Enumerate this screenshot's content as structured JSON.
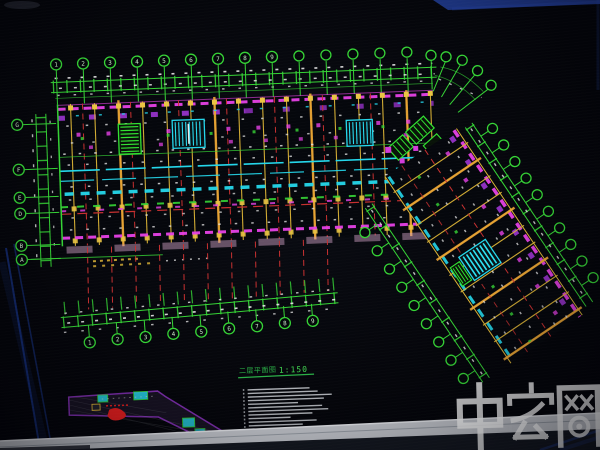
{
  "colors": {
    "background": "#05060b",
    "dimension_green": "#3bd23b",
    "grid_yellow": "#d9b33c",
    "column_orange": "#e8a43a",
    "wall_magenta": "#e043e0",
    "hatch_purple": "#a238d8",
    "detail_cyan": "#2bd5e8",
    "axis_red": "#c23232",
    "label_white": "#e8e8e8",
    "title_green": "#2fae4a",
    "bezel_gray": "#c6c9cf",
    "reflection_blue": "#2a4ab0",
    "site_plan_red": "#e02020"
  },
  "drawing": {
    "title": {
      "text": "二层平面图",
      "scale": "1:150"
    },
    "grid": {
      "top_numbers": [
        "1",
        "2",
        "3",
        "4",
        "5",
        "6",
        "7",
        "8",
        "9"
      ],
      "bottom_numbers": [
        "1",
        "2",
        "3",
        "4",
        "5",
        "6",
        "7",
        "8",
        "9"
      ],
      "left_letters": [
        "G",
        "F",
        "E",
        "D",
        "B",
        "A"
      ]
    },
    "notes": {
      "line_count": 12,
      "legible": false
    }
  },
  "watermark": {
    "text": "中宏网"
  }
}
